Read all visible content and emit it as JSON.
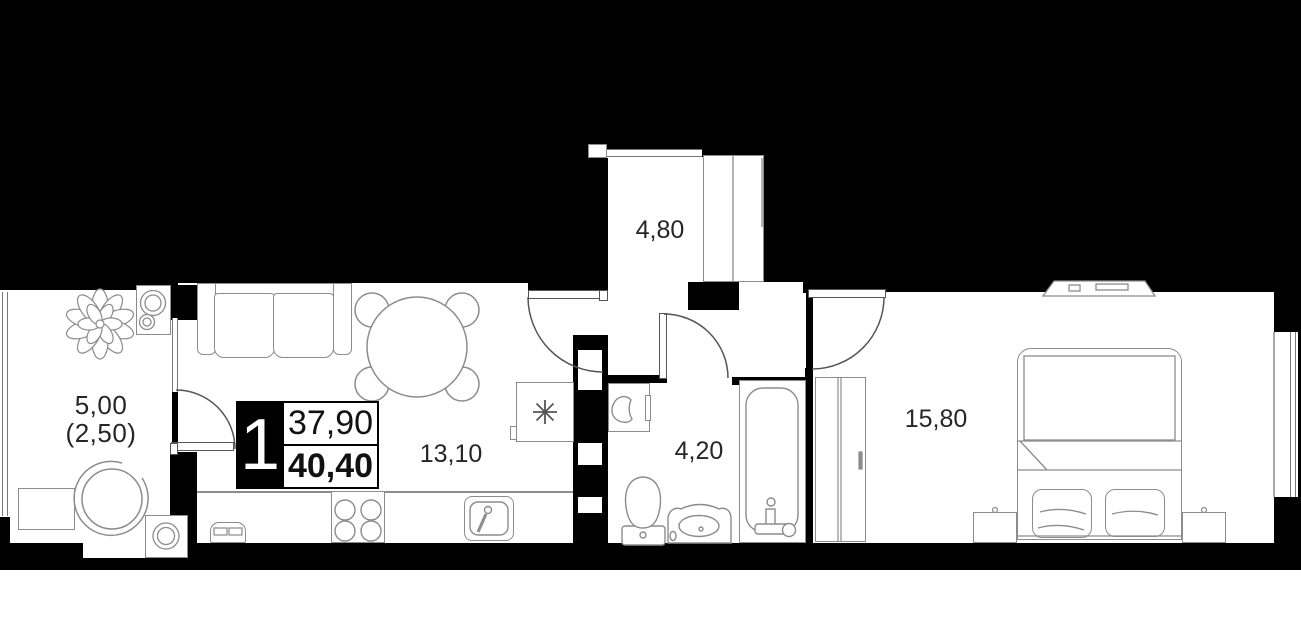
{
  "unit_badge": {
    "rooms_count": "1",
    "area_primary": "37,90",
    "area_secondary": "40,40"
  },
  "room_labels": {
    "balcony_line1": "5,00",
    "balcony_line2": "(2,50)",
    "kitchen_living": "13,10",
    "hall": "4,80",
    "bathroom": "4,20",
    "bedroom": "15,80"
  },
  "icons": {
    "hob_marker": "8-spoke-asterisk",
    "plant": "top-view-plant",
    "doors": "quarter-circle-swing-arcs"
  },
  "colors": {
    "background": "#000000",
    "floor": "#ffffff",
    "wall": "#000000",
    "furniture_line": "#8c8c8c",
    "door_line": "#555555",
    "label_text": "#262626",
    "badge_bg": "#000000",
    "badge_text": "#ffffff"
  }
}
